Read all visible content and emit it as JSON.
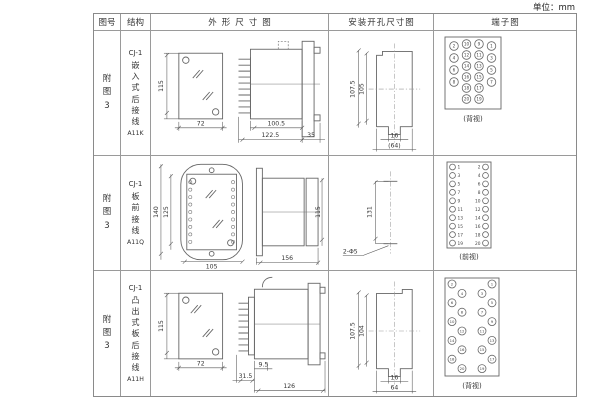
{
  "unit_label": "单位：mm",
  "headers": {
    "fig": "图号",
    "structure": "结构",
    "outline": "外形尺寸图",
    "mounting": "安装开孔尺寸图",
    "terminal": "端子图"
  },
  "rows": [
    {
      "fig_no": "附图3",
      "model": "CJ-1",
      "structure_text": "嵌入式后接线",
      "code": "A11K",
      "outline": {
        "front_height": "115",
        "front_width": "72",
        "body_depth": "100.5",
        "total_depth": "122.5",
        "flange_depth": "35"
      },
      "mounting": {
        "outer_height": "107.5",
        "inner_height": "105",
        "slot_width": "16",
        "overall_width": "(64)"
      },
      "terminal": {
        "view_label": "(背视)",
        "type": "grid4",
        "outer_left": [
          2,
          4,
          6,
          8
        ],
        "mid_left": [
          10,
          12,
          14,
          16,
          18,
          20
        ],
        "mid_right": [
          9,
          11,
          13,
          15,
          17,
          19
        ],
        "outer_right": [
          1,
          3,
          5,
          7
        ]
      }
    },
    {
      "fig_no": "附图3",
      "model": "CJ-1",
      "structure_text": "板前接线",
      "code": "A11Q",
      "outline": {
        "front_height": "140",
        "terminal_span": "125",
        "front_width": "105",
        "total_depth": "156",
        "body_height": "115"
      },
      "mounting": {
        "hole_distance": "131",
        "hole_label": "2-Φ5"
      },
      "terminal": {
        "view_label": "(前视)",
        "type": "cols2",
        "left": [
          1,
          3,
          5,
          7,
          9,
          11,
          13,
          15,
          17,
          19
        ],
        "right": [
          2,
          4,
          6,
          8,
          10,
          12,
          14,
          16,
          18,
          20
        ]
      }
    },
    {
      "fig_no": "附图3",
      "model": "CJ-1",
      "structure_text": "凸出式板后接线",
      "code": "A11H",
      "outline": {
        "front_height": "115",
        "front_width": "72",
        "pin_depth": "31.5",
        "offset": "9.5",
        "body_depth": "126"
      },
      "mounting": {
        "outer_height": "107.5",
        "inner_height": "104",
        "slot_width": "16",
        "overall_width": "64"
      },
      "terminal": {
        "view_label": "(背视)",
        "type": "staggered",
        "left": [
          2,
          4,
          6,
          8,
          10,
          12,
          14,
          16,
          18,
          20
        ],
        "right": [
          1,
          3,
          5,
          7,
          9,
          11,
          13,
          15,
          17,
          19
        ]
      }
    }
  ]
}
